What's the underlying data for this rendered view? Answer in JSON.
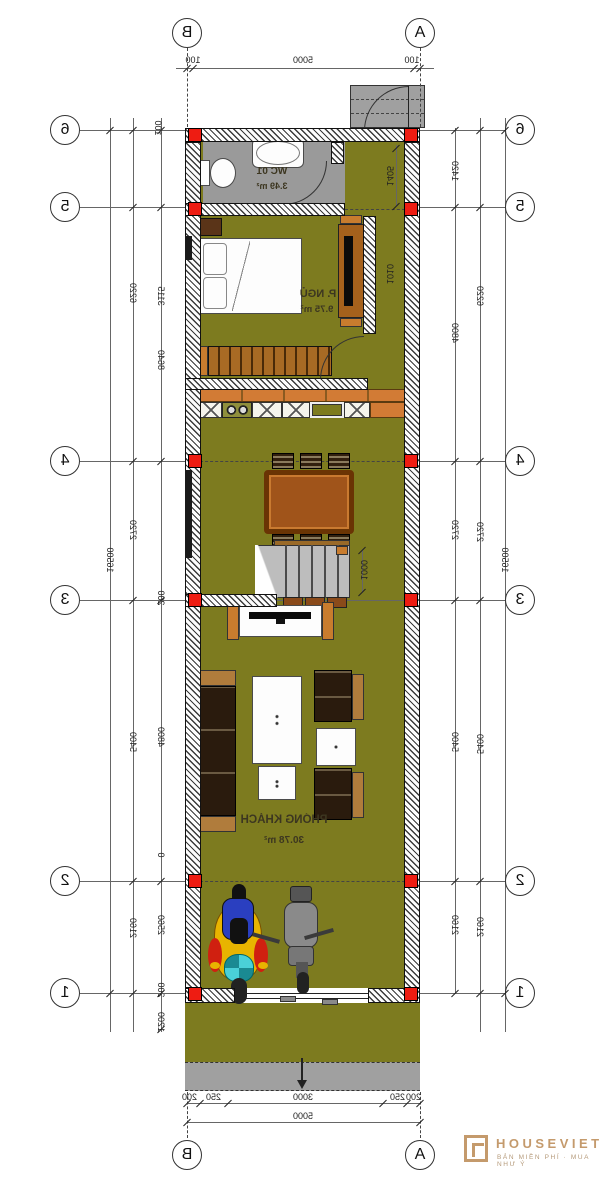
{
  "grid": {
    "b": "B",
    "a": "A",
    "rows": [
      "6",
      "5",
      "4",
      "3",
      "2",
      "1"
    ]
  },
  "dims": {
    "top": {
      "left_offset": "100",
      "span": "5000",
      "right_offset": "100"
    },
    "bottom": {
      "segments": [
        "200",
        "250",
        "3000",
        "250",
        "200"
      ],
      "total": "5000"
    },
    "left": {
      "outer": "16500",
      "mid": [
        "6220",
        "2720",
        "5400",
        "2160"
      ],
      "inner": [
        "100",
        "3115",
        "8640",
        "200",
        "4800",
        "0",
        "2560",
        "200",
        "1200"
      ]
    },
    "right": {
      "outer": "16500",
      "mid": [
        "6220",
        "2720",
        "5400",
        "2160"
      ],
      "inner": [
        "1420",
        "4800",
        "2720",
        "5400",
        "2160"
      ]
    },
    "interior": {
      "entry_hall": "1405",
      "bed_nook": "1010",
      "stairs": "1000"
    }
  },
  "rooms": {
    "wc": {
      "name": "WC 01",
      "area": "3.49 m²"
    },
    "bedroom": {
      "name": "P. NGỦ",
      "area": "9.75 m²"
    },
    "living": {
      "name": "PHÒNG KHÁCH",
      "area": "30.78 m²"
    }
  },
  "logo": {
    "brand": "HOUSEVIET",
    "tagline": "BẢN MIỀN PHÍ · MUA NHƯ Ý"
  },
  "colors": {
    "floor": "#7d7b1f",
    "wc_floor": "#9a9a9a",
    "column": "#ee1c12",
    "logo": "#c49a6c"
  }
}
